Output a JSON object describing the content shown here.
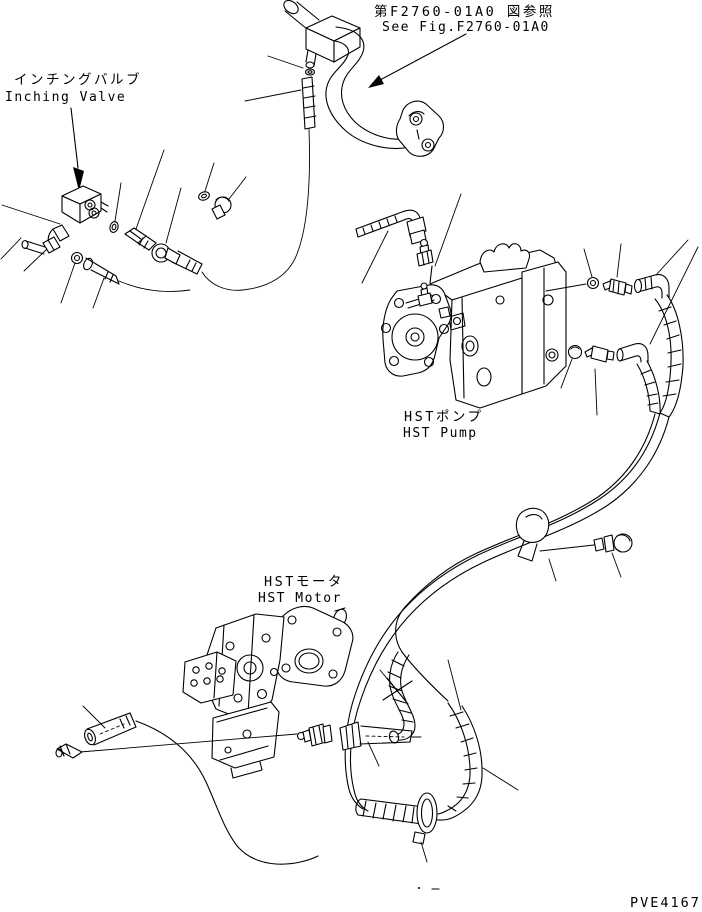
{
  "colors": {
    "background": "#ffffff",
    "line": "#000000"
  },
  "reference_note": {
    "jp": "第F2760-01A0 図参照",
    "en": "See Fig.F2760-01A0"
  },
  "labels": {
    "inching_valve": {
      "jp": "インチングバルブ",
      "en": "Inching Valve"
    },
    "hst_pump": {
      "jp": "HSTポンプ",
      "en": "HST Pump"
    },
    "hst_motor": {
      "jp": "HSTモータ",
      "en": "HST Motor"
    }
  },
  "footer": {
    "drawing_code": "PVE4167"
  }
}
